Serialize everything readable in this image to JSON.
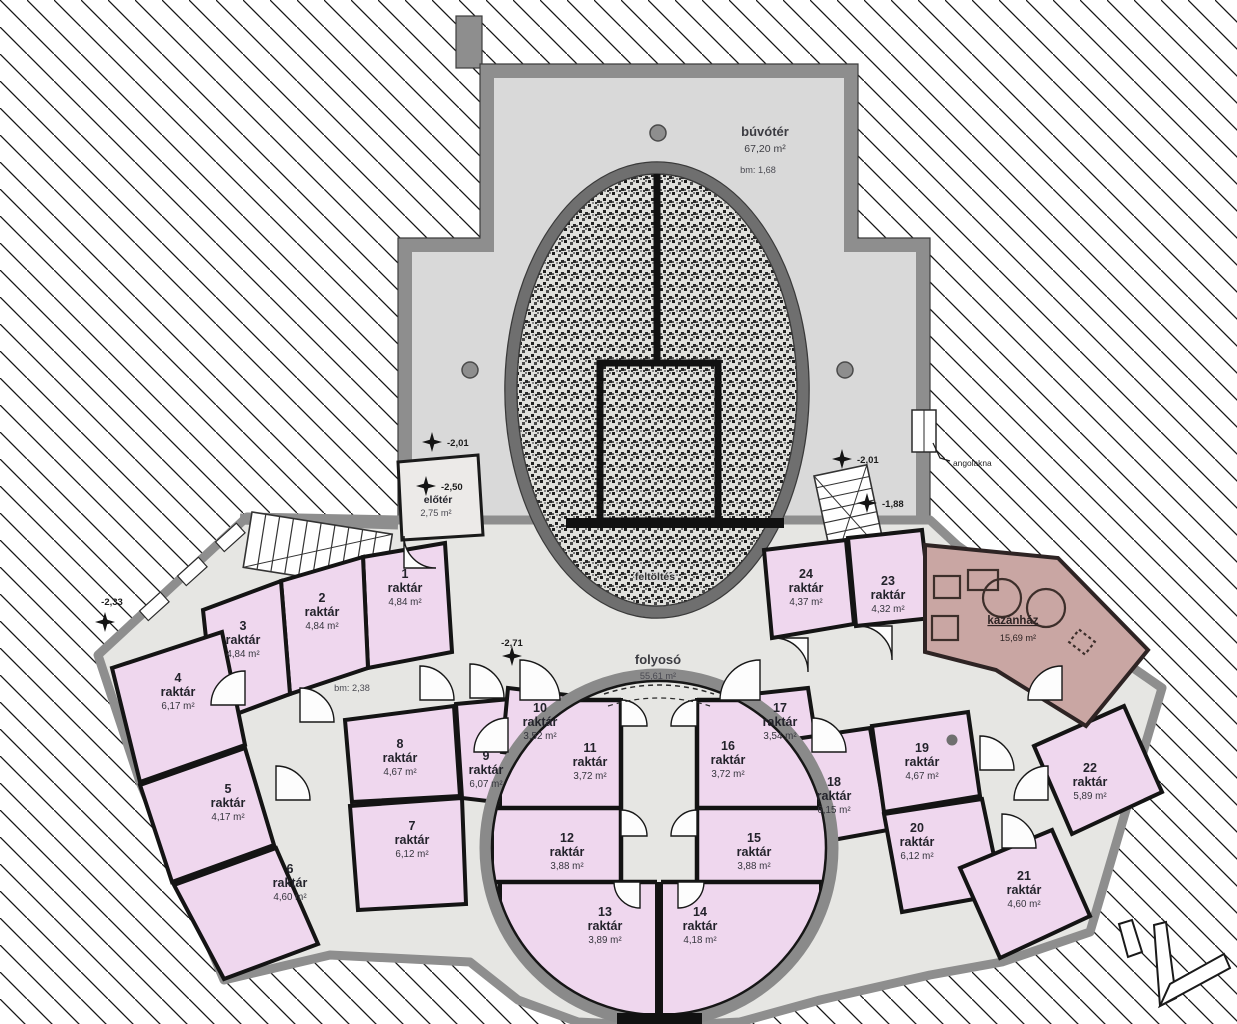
{
  "plan": {
    "language": "hu",
    "unit": "m²"
  },
  "rooms": [
    {
      "number": "1",
      "name": "raktár",
      "area": "4,84 m²"
    },
    {
      "number": "2",
      "name": "raktár",
      "area": "4,84 m²"
    },
    {
      "number": "3",
      "name": "raktár",
      "area": "4,84 m²"
    },
    {
      "number": "4",
      "name": "raktár",
      "area": "6,17 m²"
    },
    {
      "number": "5",
      "name": "raktár",
      "area": "4,17 m²"
    },
    {
      "number": "6",
      "name": "raktár",
      "area": "4,60 m²"
    },
    {
      "number": "7",
      "name": "raktár",
      "area": "6,12 m²"
    },
    {
      "number": "8",
      "name": "raktár",
      "area": "4,67 m²"
    },
    {
      "number": "9",
      "name": "raktár",
      "area": "6,07 m²"
    },
    {
      "number": "10",
      "name": "raktár",
      "area": "3,52 m²"
    },
    {
      "number": "11",
      "name": "raktár",
      "area": "3,72 m²"
    },
    {
      "number": "12",
      "name": "raktár",
      "area": "3,88 m²"
    },
    {
      "number": "13",
      "name": "raktár",
      "area": "3,89 m²"
    },
    {
      "number": "14",
      "name": "raktár",
      "area": "4,18 m²"
    },
    {
      "number": "15",
      "name": "raktár",
      "area": "3,88 m²"
    },
    {
      "number": "16",
      "name": "raktár",
      "area": "3,72 m²"
    },
    {
      "number": "17",
      "name": "raktár",
      "area": "3,54 m²"
    },
    {
      "number": "18",
      "name": "raktár",
      "area": "6,15 m²"
    },
    {
      "number": "19",
      "name": "raktár",
      "area": "4,67 m²"
    },
    {
      "number": "20",
      "name": "raktár",
      "area": "6,12 m²"
    },
    {
      "number": "21",
      "name": "raktár",
      "area": "4,60 m²"
    },
    {
      "number": "22",
      "name": "raktár",
      "area": "5,89 m²"
    },
    {
      "number": "23",
      "name": "raktár",
      "area": "4,32 m²"
    },
    {
      "number": "24",
      "name": "raktár",
      "area": "4,37 m²"
    }
  ],
  "areas": {
    "buvoter": {
      "name": "búvótér",
      "area": "67,20 m²",
      "bm": "bm: 1,68"
    },
    "folyoso": {
      "name": "folyosó",
      "area": "55,61 m²",
      "bm": "bm: 2,38"
    },
    "eloter": {
      "name": "előtér",
      "area": "2,75 m²"
    },
    "kazanhaz": {
      "name": "kazánház",
      "area": "15,69 m²"
    },
    "feltoltes": {
      "name": "feltöltés"
    }
  },
  "markers": {
    "m233": {
      "label": "-2,33"
    },
    "m201l": {
      "label": "-2,01"
    },
    "m250": {
      "label": "-2,50"
    },
    "m271": {
      "label": "-2,71"
    },
    "m201r": {
      "label": "-2,01"
    },
    "m188": {
      "label": "-1,88"
    }
  },
  "annotations": {
    "angolakna": "angolakna"
  },
  "colors": {
    "room_fill": "#efd7ee",
    "boiler_fill": "#c9a6a3",
    "wall_gray": "#8e8e8e",
    "interior_gray": "#d9d9d9",
    "corridor_gray": "#e6e6e3",
    "wall_black": "#141414"
  }
}
